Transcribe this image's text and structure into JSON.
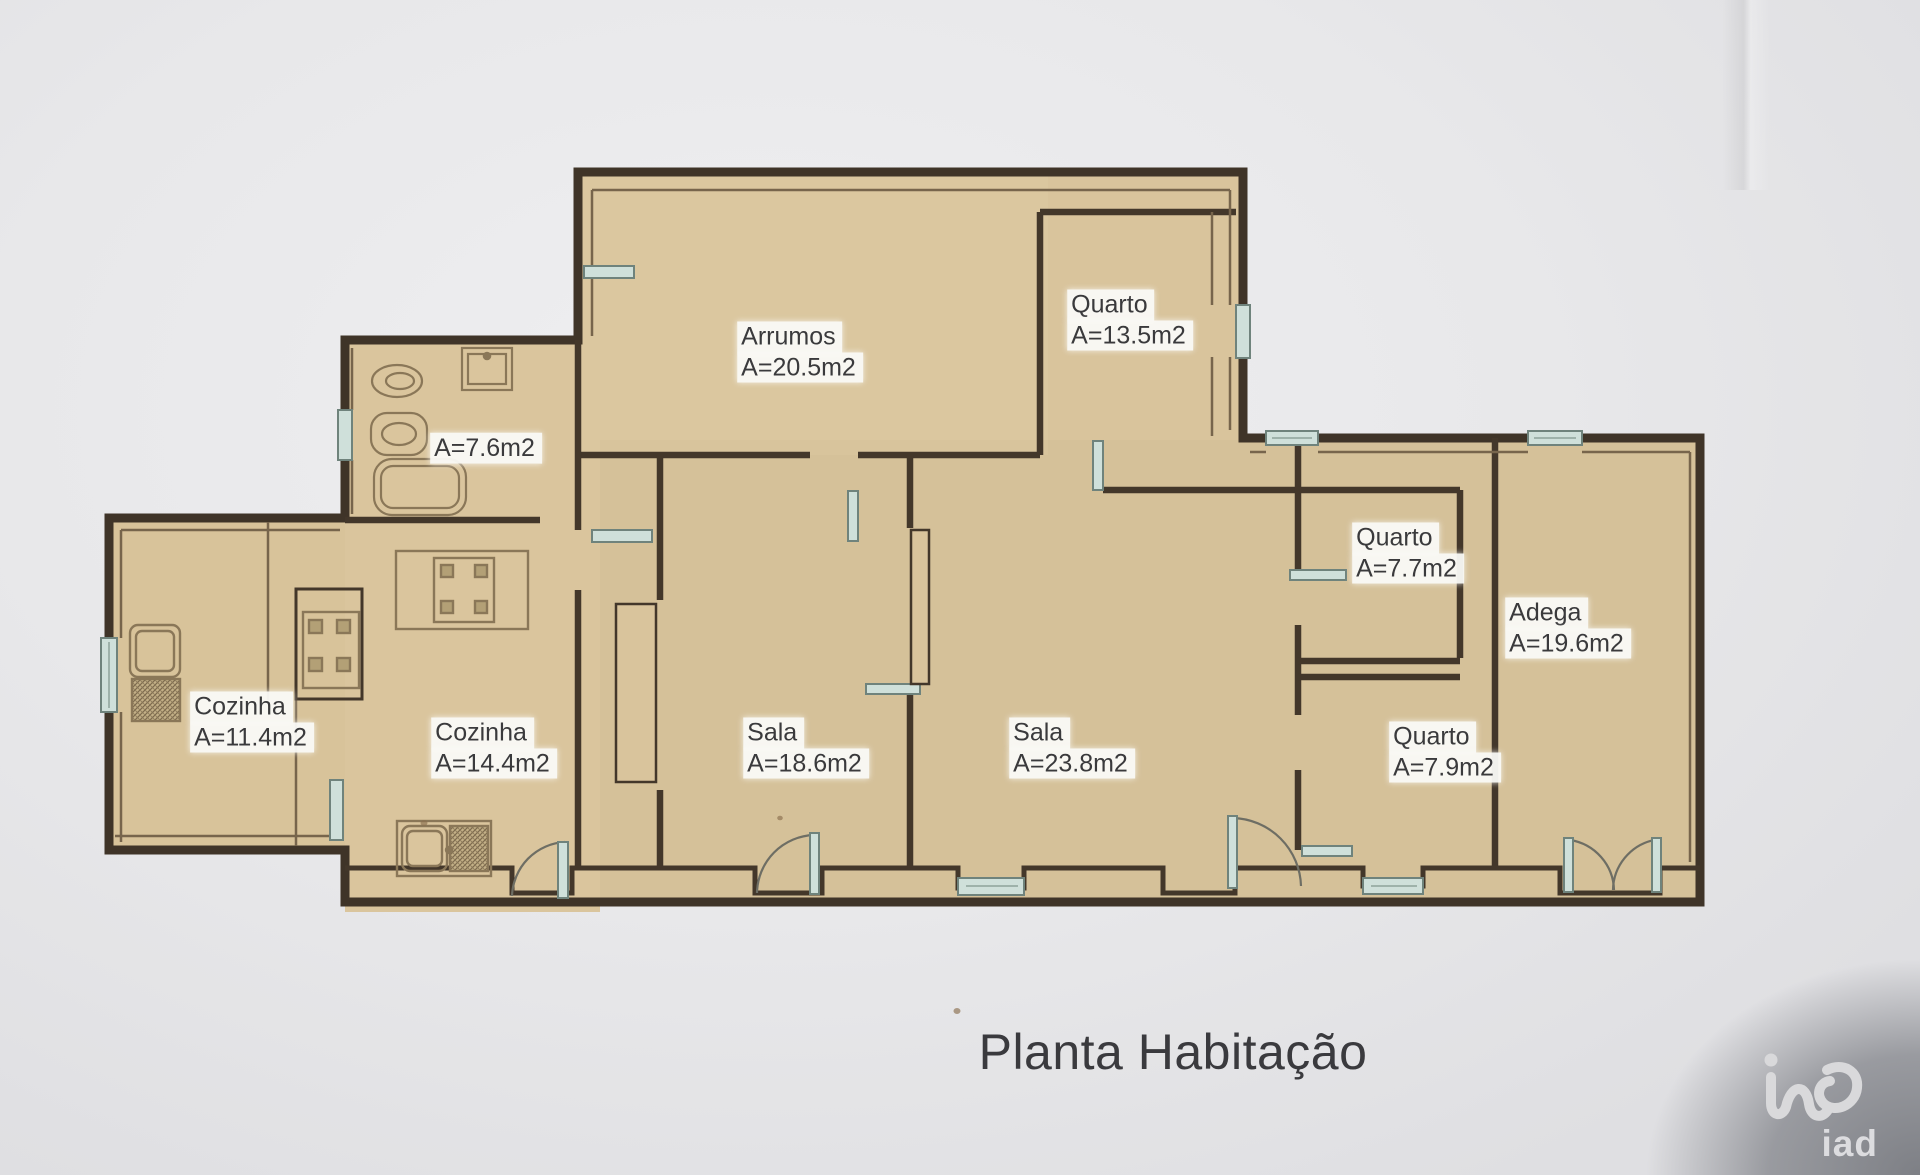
{
  "title": "Planta Habitação",
  "logo": {
    "mark": "iad-logo",
    "text": "iad"
  },
  "colors": {
    "paper": "#e8e8ea",
    "floor": "#d9c49c",
    "wall": "#3f3428",
    "window": "#cfe0da",
    "label_bg": "#faf9f6",
    "label_text": "#3a3a3c"
  },
  "rooms": [
    {
      "id": "arrumos",
      "name": "Arrumos",
      "area": "A=20.5m2",
      "x": 800,
      "y": 352
    },
    {
      "id": "quarto-135",
      "name": "Quarto",
      "area": "A=13.5m2",
      "x": 1130,
      "y": 320
    },
    {
      "id": "banho-76",
      "name": "",
      "area": "A=7.6m2",
      "x": 486,
      "y": 448
    },
    {
      "id": "quarto-77",
      "name": "Quarto",
      "area": "A=7.7m2",
      "x": 1408,
      "y": 553
    },
    {
      "id": "adega-196",
      "name": "Adega",
      "area": "A=19.6m2",
      "x": 1568,
      "y": 628
    },
    {
      "id": "cozinha-114",
      "name": "Cozinha",
      "area": "A=11.4m2",
      "x": 252,
      "y": 722
    },
    {
      "id": "cozinha-144",
      "name": "Cozinha",
      "area": "A=14.4m2",
      "x": 494,
      "y": 748
    },
    {
      "id": "sala-186",
      "name": "Sala",
      "area": "A=18.6m2",
      "x": 806,
      "y": 748
    },
    {
      "id": "sala-238",
      "name": "Sala",
      "area": "A=23.8m2",
      "x": 1072,
      "y": 748
    },
    {
      "id": "quarto-79",
      "name": "Quarto",
      "area": "A=7.9m2",
      "x": 1445,
      "y": 752
    }
  ]
}
